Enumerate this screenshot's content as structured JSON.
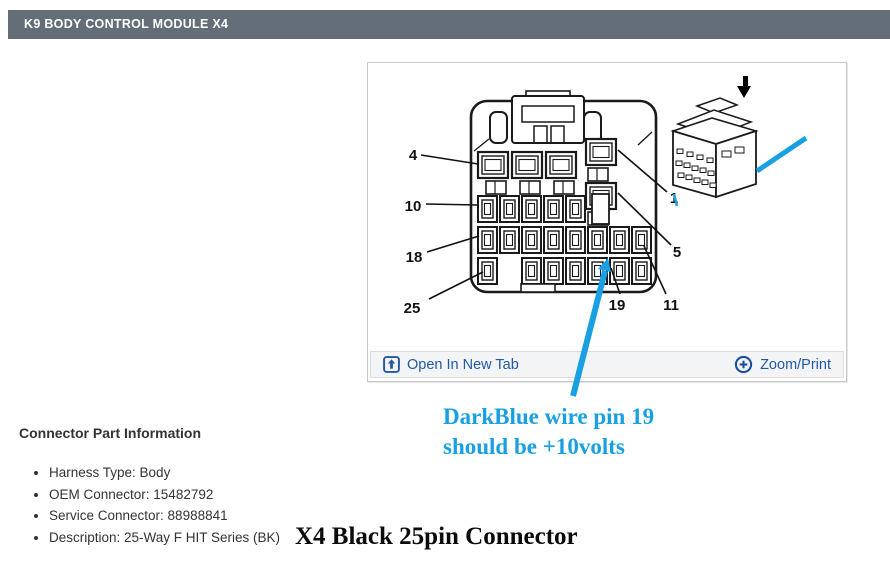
{
  "header": {
    "title": "K9 BODY CONTROL MODULE X4"
  },
  "viewer": {
    "open_in_new_tab_label": "Open In New Tab",
    "zoom_print_label": "Zoom/Print"
  },
  "diagram": {
    "pins": {
      "p4": "4",
      "p10": "10",
      "p18": "18",
      "p25": "25",
      "p1": "1",
      "p5": "5",
      "p19": "19",
      "p11": "11"
    }
  },
  "annotation": {
    "line1": "DarkBlue wire pin 19",
    "line2": "should be +10volts"
  },
  "part_info": {
    "heading": "Connector Part Information",
    "items": [
      "Harness Type: Body",
      "OEM Connector: 15482792",
      "Service Connector: 88988841",
      "Description: 25-Way F HIT Series (BK)"
    ]
  },
  "caption": "X4 Black 25pin Connector",
  "colors": {
    "header_bg": "#646e79",
    "link_blue": "#2159a8",
    "annotation_cyan": "#18a0e2",
    "line_black": "#1a1a1a"
  }
}
